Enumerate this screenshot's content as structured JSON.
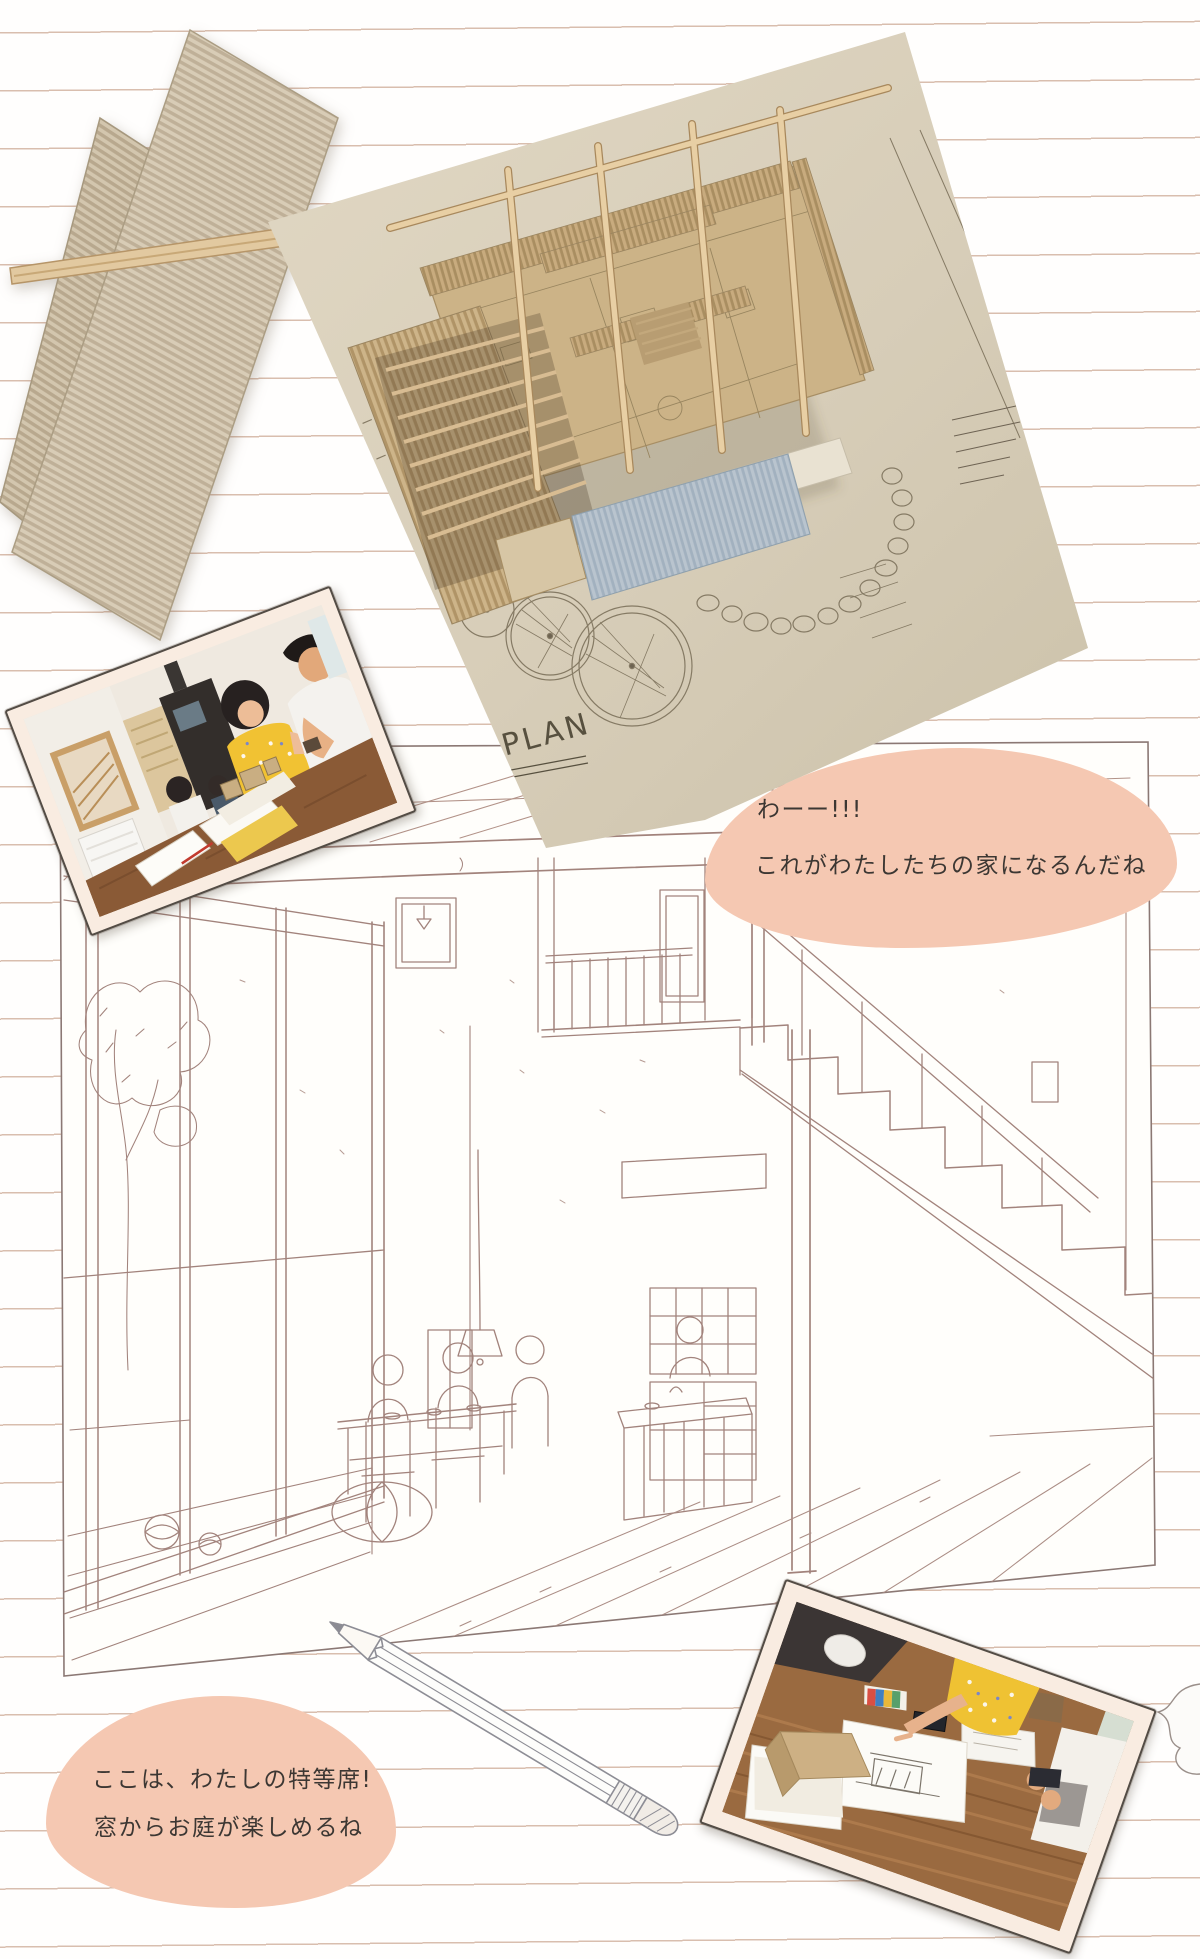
{
  "page": {
    "width": 1200,
    "height": 1959,
    "background": "#fffefd",
    "ruled_line_color": "#ba896d",
    "ruled_line_spacing_px": 58
  },
  "speech_bubbles": {
    "top": {
      "line1": "わーー!!!",
      "line2": "これがわたしたちの家になるんだね",
      "fill": "#f5c8b2",
      "text_color": "#3c3733"
    },
    "bottom": {
      "line1": "ここは、わたしの特等席!",
      "line2": "窓からお庭が楽しめるね",
      "fill": "#f5c8b2",
      "text_color": "#3c3733"
    }
  },
  "model_photo": {
    "plan_label": "1F PLAN",
    "plan_scale": "S=1/50",
    "paper_color": "#d9cfba",
    "cardboard_color": "#ccb387",
    "roof_panel_color": "#b7c2cc",
    "dowel_color": "#e8cfa4"
  },
  "cardboard_sheets": {
    "base_color": "#d8ccb6",
    "flute_color": "#bfb098",
    "stick_color": "#e2c9a0"
  },
  "interior_sketch": {
    "stroke_color": "#a2837c",
    "paper_color": "#fffefb"
  },
  "pencil_illustration": {
    "stroke_color": "#8d8d95"
  }
}
